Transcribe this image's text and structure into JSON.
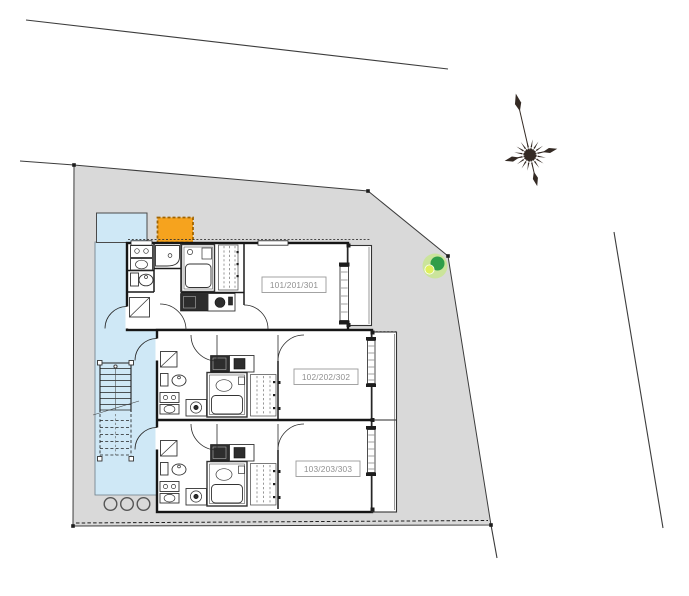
{
  "plan": {
    "units": [
      {
        "label": "101/201/301"
      },
      {
        "label": "102/202/302"
      },
      {
        "label": "103/203/303"
      }
    ],
    "features": {
      "stairs": "exterior-staircase",
      "walkway": "shared-corridor",
      "parking": "parking-space",
      "meters": "utility-meters"
    },
    "icons": [
      {
        "name": "compass-rose-icon"
      },
      {
        "name": "tree-icon"
      }
    ]
  },
  "colors": {
    "site_fill": "#d9d9d9",
    "walkway_fill": "#cfe8f6",
    "parking_fill": "#f6a31e",
    "parking_border": "#a06400",
    "tree_outer": "#cbe49b",
    "tree_inner": "#2f9e48",
    "tree_accent": "#dff05e"
  }
}
